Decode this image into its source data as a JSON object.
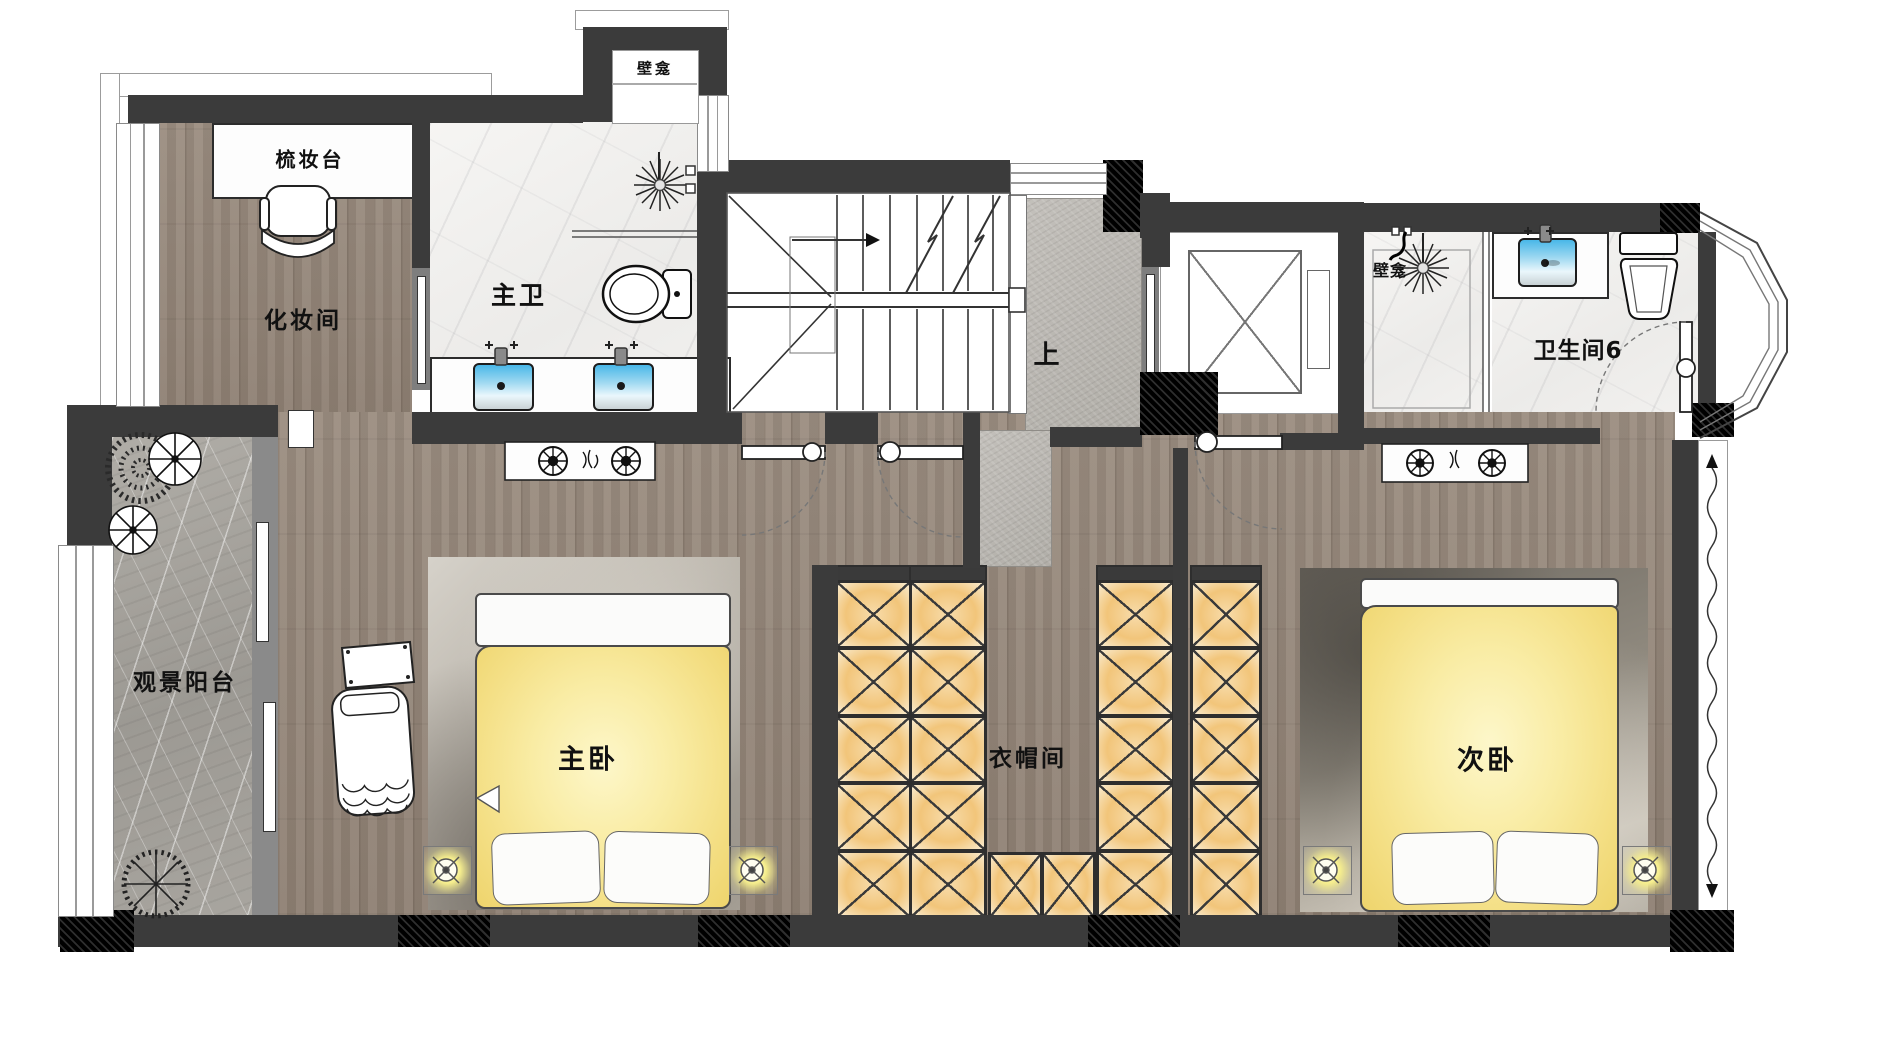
{
  "floorplan": {
    "labels": {
      "niche_top": "壁龛",
      "dressing_table": "梳妆台",
      "makeup_room": "化妆间",
      "master_bathroom": "主卫",
      "stairs_up": "上",
      "shower_niche": "壁龛",
      "bathroom_6": "卫生间6",
      "viewing_balcony": "观景阳台",
      "master_bedroom": "主卧",
      "walk_in_closet": "衣帽间",
      "second_bedroom": "次卧"
    },
    "colors": {
      "wall": "#3b3b3b",
      "structure_black": "#141414",
      "wood_floor": "#94867a",
      "marble_floor": "#f3f2f0",
      "stone_floor": "#b8b5af",
      "balcony_stone": "#a6a39d",
      "bed_glow": "#f7e193",
      "wardrobe_glow": "#f2c87e",
      "sink_blue": "#45b2e2",
      "downlight_yellow": "#f3ef9a"
    }
  }
}
